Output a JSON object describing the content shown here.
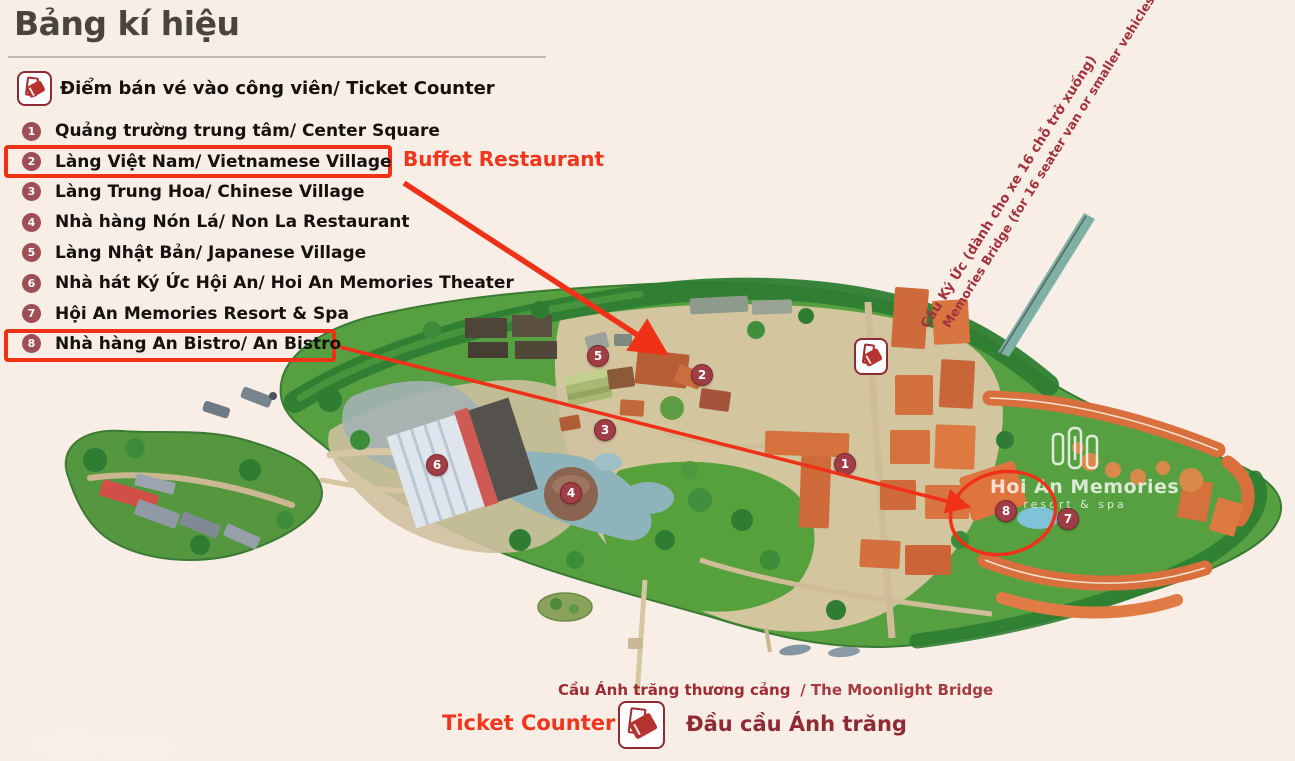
{
  "title": "Bảng kí hiệu",
  "legend": {
    "ticket_label": "Điểm bán vé vào công viên/ Ticket Counter",
    "items": [
      {
        "number": "1",
        "label": "Quảng trường trung tâm/ Center Square"
      },
      {
        "number": "2",
        "label": "Làng Việt Nam/ Vietnamese Village"
      },
      {
        "number": "3",
        "label": "Làng Trung Hoa/ Chinese Village"
      },
      {
        "number": "4",
        "label": "Nhà hàng Nón Lá/ Non La Restaurant"
      },
      {
        "number": "5",
        "label": "Làng Nhật Bản/ Japanese Village"
      },
      {
        "number": "6",
        "label": "Nhà hát Ký Ức Hội An/ Hoi An Memories Theater"
      },
      {
        "number": "7",
        "label": "Hội An Memories Resort & Spa"
      },
      {
        "number": "8",
        "label": "Nhà hàng An Bistro/ An Bistro"
      }
    ]
  },
  "annotations": {
    "buffet_label": "Buffet Restaurant",
    "ticket_counter_label": "Ticket Counter"
  },
  "map": {
    "markers": [
      {
        "number": "1"
      },
      {
        "number": "2"
      },
      {
        "number": "3"
      },
      {
        "number": "4"
      },
      {
        "number": "5"
      },
      {
        "number": "6"
      },
      {
        "number": "7"
      },
      {
        "number": "8"
      }
    ],
    "watermark": {
      "line1": "Hoi An Memories",
      "line2": "resort & spa"
    },
    "memories_bridge_label": {
      "vi": "Cầu Ký Ức (dành cho xe 16 chỗ trở xuống)",
      "en": "Memories Bridge (for 16 seater van or smaller vehicles)"
    },
    "moonlight_bridge_label": {
      "vi": "Cầu Ánh trăng thương cảng",
      "en": "/ The Moonlight Bridge"
    },
    "moonlight_head_label": "Đầu cầu Ánh trăng"
  },
  "colors": {
    "background": "#f8eee5",
    "accent_red": "#ef3118",
    "dark_red": "#9e2b33",
    "badge_maroon": "#9d4f55",
    "title_gray": "#4a443f",
    "island_green": "#54a040",
    "water_blue": "#92b0b6",
    "roof_orange": "#dd6f3c"
  }
}
